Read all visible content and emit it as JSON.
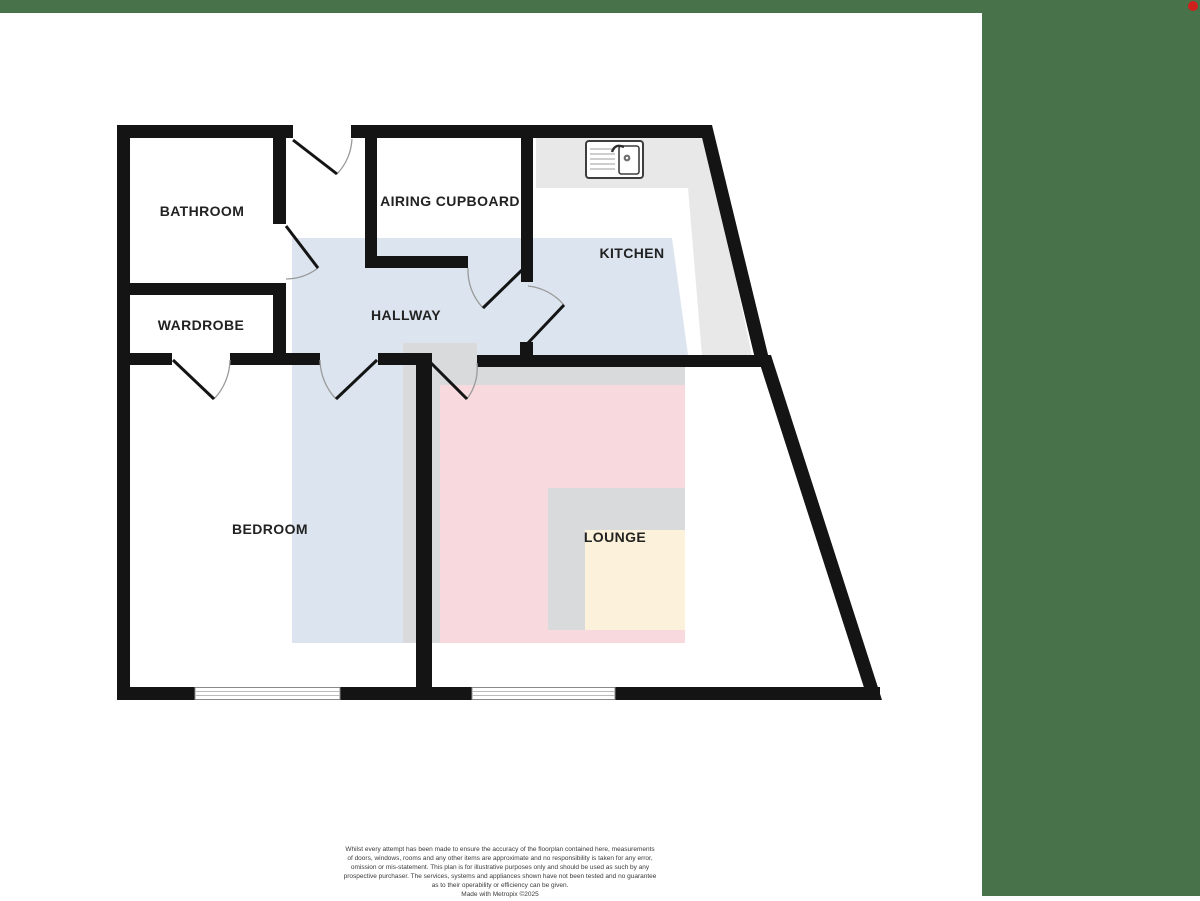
{
  "branding": {
    "top_bar_color": "#487249",
    "side_panel_color": "#487249",
    "notification_dot_color": "#d0201c"
  },
  "floorplan": {
    "rooms": [
      {
        "id": "bathroom",
        "label": "BATHROOM"
      },
      {
        "id": "airing-cupboard",
        "label": "AIRING CUPBOARD"
      },
      {
        "id": "kitchen",
        "label": "KITCHEN"
      },
      {
        "id": "wardrobe",
        "label": "WARDROBE"
      },
      {
        "id": "hallway",
        "label": "HALLWAY"
      },
      {
        "id": "bedroom",
        "label": "BEDROOM"
      },
      {
        "id": "lounge",
        "label": "LOUNGE"
      }
    ],
    "colors": {
      "wall": "#141414",
      "hallway_overlay": "#dce5ef",
      "lounge_overlay": "#f8d9de",
      "lounge_inner_overlay": "#fcf2db",
      "counter_gray": "#e8e8e8",
      "zone_gray": "#d8dadc",
      "door_arc": "#9a9a9a",
      "window_line": "#aaaaaa"
    },
    "fixtures": [
      {
        "id": "sink",
        "name": "kitchen-sink"
      }
    ],
    "doors": [
      "entrance",
      "bathroom",
      "wardrobe",
      "bedroom",
      "lounge",
      "kitchen",
      "airing-cupboard"
    ],
    "windows": [
      "bedroom-window",
      "lounge-window"
    ]
  },
  "disclaimer": {
    "lines": [
      "Whilst every attempt has been made to ensure the accuracy of the floorplan contained here, measurements",
      "of doors, windows, rooms and any other items are approximate and no responsibility is taken for any error,",
      "omission or mis-statement. This plan is for illustrative purposes only and should be used as such by any",
      "prospective purchaser. The services, systems and appliances shown have not been tested and no guarantee",
      "as to their operability or efficiency can be given."
    ],
    "credit": "Made with Metropix ©2025"
  }
}
